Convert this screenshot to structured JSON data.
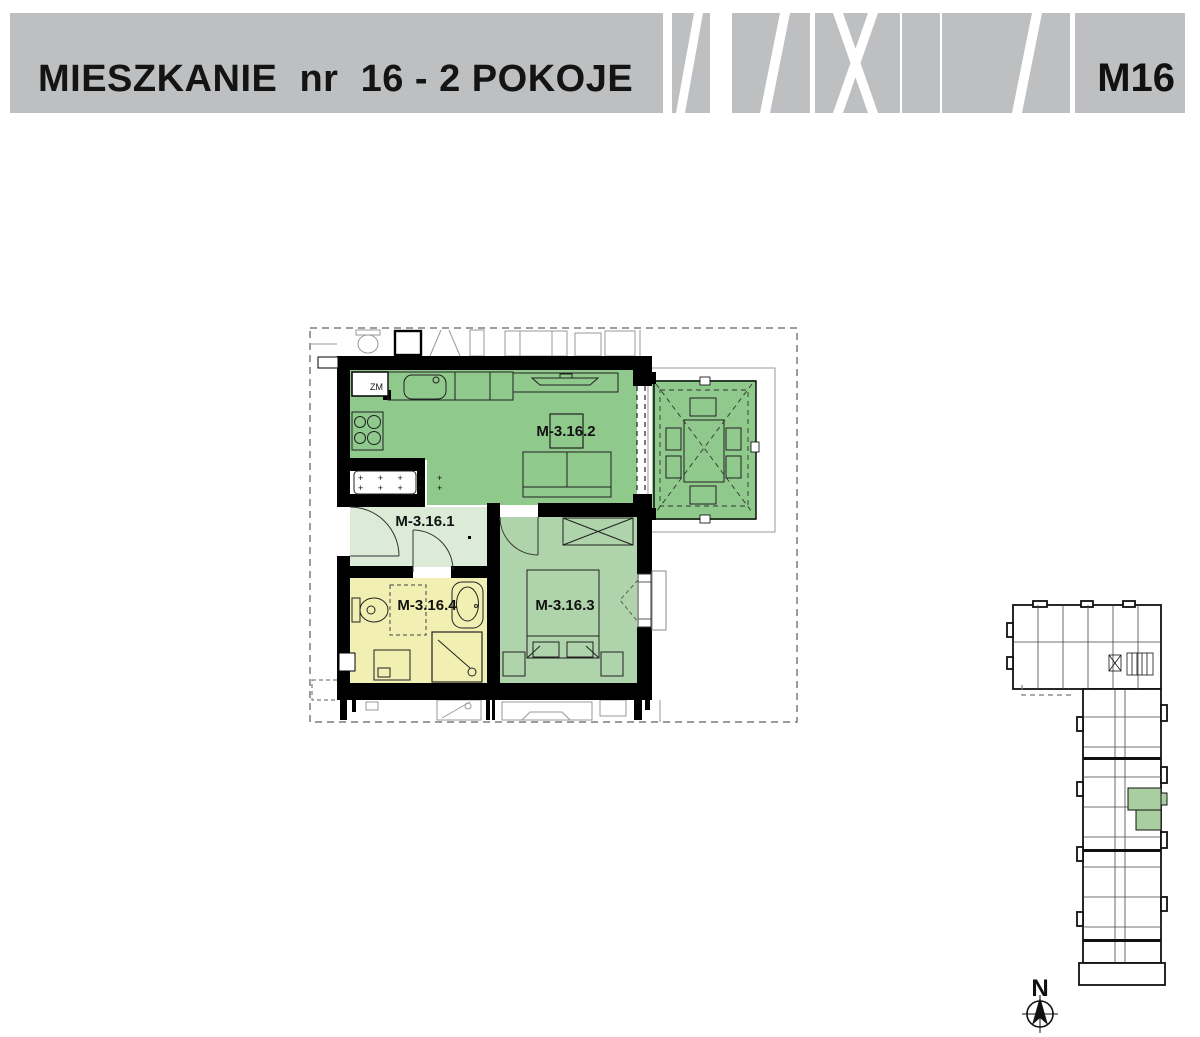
{
  "header": {
    "title": "MIESZKANIE  nr  16 - 2 POKOJE",
    "unit_code": "M16"
  },
  "plan": {
    "rooms": [
      {
        "id": "hallway",
        "label": "M-3.16.1",
        "color": "#dcebd8"
      },
      {
        "id": "living-kitchen",
        "label": "M-3.16.2",
        "color": "#8fc98c"
      },
      {
        "id": "bedroom",
        "label": "M-3.16.3",
        "color": "#afd3aa"
      },
      {
        "id": "bathroom",
        "label": "M-3.16.4",
        "color": "#f2efb3"
      }
    ],
    "balcony_color": "#8fc98c",
    "kitchen_sink_label": "ZM",
    "radiator_hatch": "+ + + + +"
  },
  "overview": {
    "highlight_color": "#a9cfa0",
    "compass_north_label": "N"
  }
}
